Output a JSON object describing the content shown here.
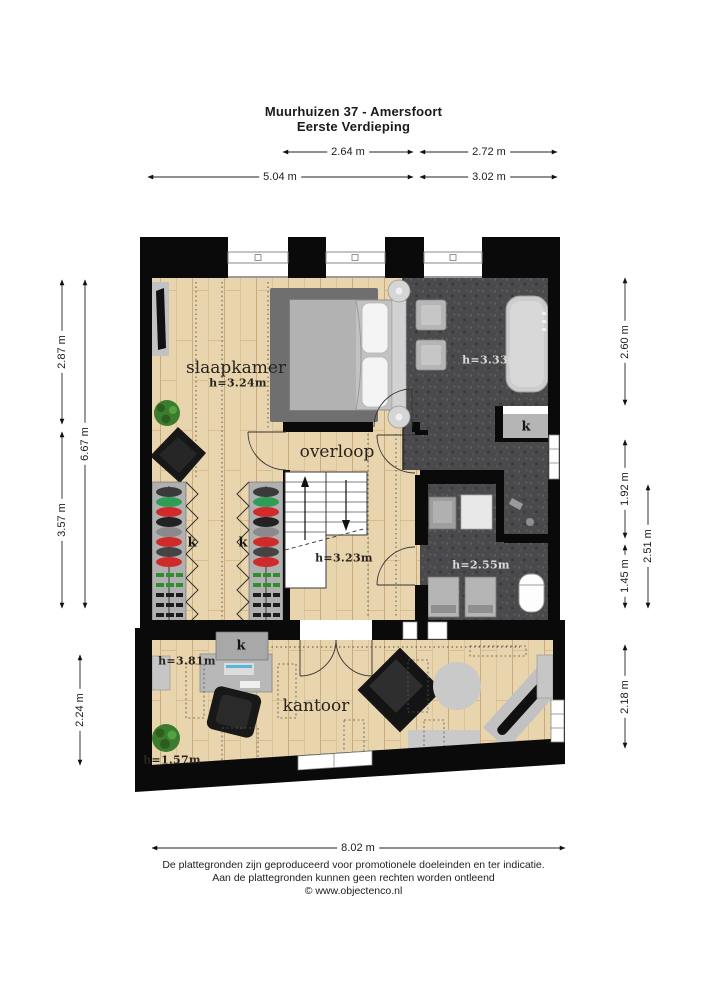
{
  "title": {
    "line1": "Muurhuizen 37 - Amersfoort",
    "line2": "Eerste Verdieping"
  },
  "dimensions": {
    "top_inner_left": "2.64 m",
    "top_inner_right": "2.72 m",
    "top_outer_left": "5.04 m",
    "top_outer_right": "3.02 m",
    "left_upper": "2.87 m",
    "left_lower": "3.57 m",
    "left_total": "6.67 m",
    "left_kantoor": "2.24 m",
    "right_upper": "2.60 m",
    "right_middle": "1.92 m",
    "right_lower": "1.45 m",
    "right_total_lower": "2.51 m",
    "right_kantoor": "2.18 m",
    "bottom_total": "8.02 m"
  },
  "rooms": {
    "slaapkamer": {
      "name": "slaapkamer",
      "ceiling": "h=3.24m"
    },
    "overloop": {
      "name": "overloop",
      "ceiling": "h=3.23m"
    },
    "badkamer": {
      "ceiling": "h=3.33m"
    },
    "wasruimte": {
      "ceiling": "h=2.55m"
    },
    "kantoor": {
      "name": "kantoor",
      "ceiling_high": "h=3.81m",
      "ceiling_low": "h=1.57m"
    },
    "closet_label": "k"
  },
  "footer": {
    "line1": "De plattegronden zijn geproduceerd voor promotionele doeleinden en ter indicatie.",
    "line2": "Aan de plattegronden kunnen geen rechten worden ontleend",
    "line3": "© www.objectenco.nl"
  },
  "colors": {
    "wall": "#0a0a0a",
    "wood_floor": "#e8d4ad",
    "tile_floor": "#4a4a4d"
  }
}
